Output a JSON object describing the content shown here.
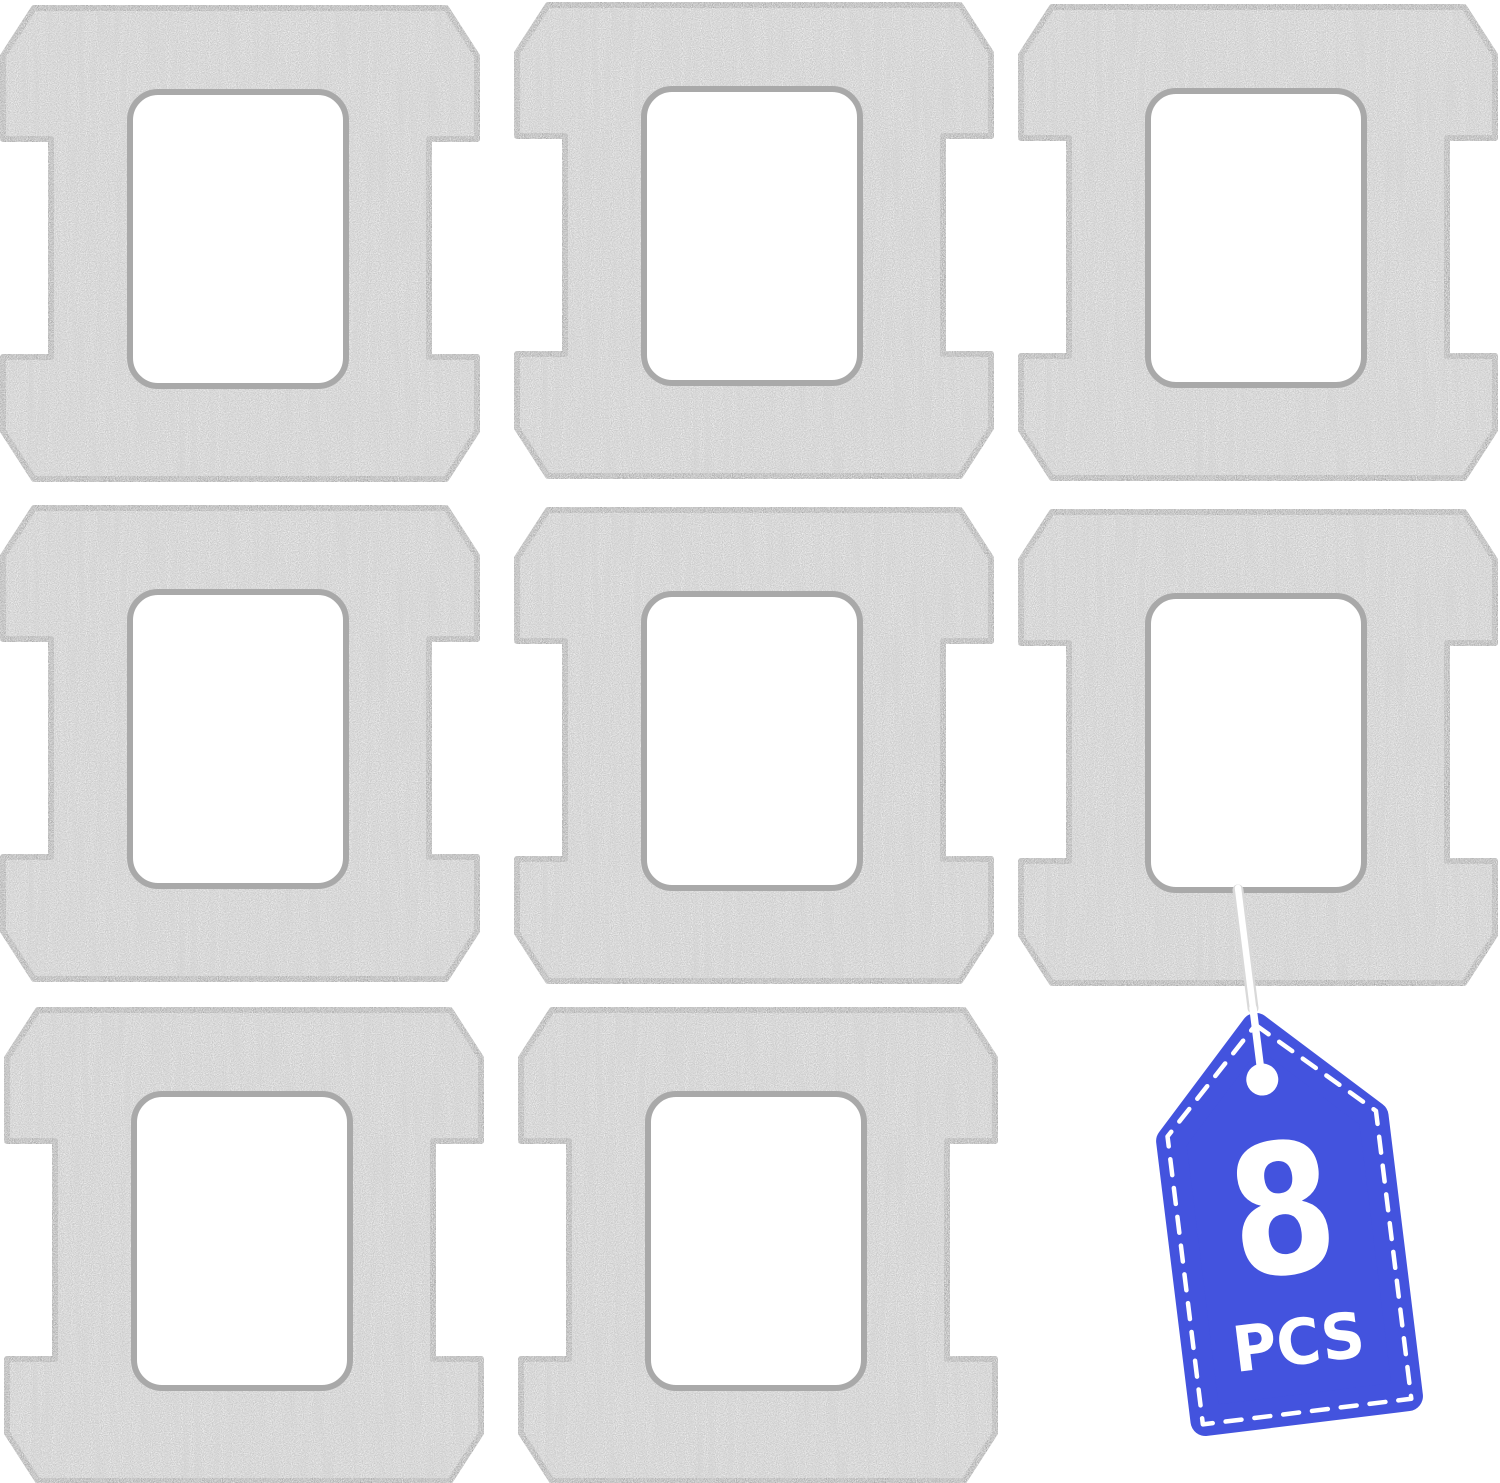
{
  "badge": {
    "count": "8",
    "unit": "PCS"
  },
  "colors": {
    "background": "#ffffff",
    "pad_fill": "#c9c9c9",
    "pad_edge": "#a8a8a8",
    "hole_fill": "#ffffff",
    "hole_edge": "#a9a9a9",
    "tag_blue": "#4353de",
    "tag_text": "#ffffff",
    "string_core": "#ffffff",
    "string_shadow": "#d9d9d9"
  },
  "pads": {
    "count": 8,
    "rows": 3,
    "cols": 3,
    "items": [
      {
        "id": "mop-pad-1",
        "row": 1,
        "col": 1,
        "x": 3,
        "y": 8
      },
      {
        "id": "mop-pad-2",
        "row": 1,
        "col": 2,
        "x": 517,
        "y": 5
      },
      {
        "id": "mop-pad-3",
        "row": 1,
        "col": 3,
        "x": 1021,
        "y": 7
      },
      {
        "id": "mop-pad-4",
        "row": 2,
        "col": 1,
        "x": 3,
        "y": 508
      },
      {
        "id": "mop-pad-5",
        "row": 2,
        "col": 2,
        "x": 517,
        "y": 510
      },
      {
        "id": "mop-pad-6",
        "row": 2,
        "col": 3,
        "x": 1021,
        "y": 512
      },
      {
        "id": "mop-pad-7",
        "row": 3,
        "col": 1,
        "x": 7,
        "y": 1010
      },
      {
        "id": "mop-pad-8",
        "row": 3,
        "col": 2,
        "x": 521,
        "y": 1010
      }
    ]
  },
  "tag": {
    "x": 1155,
    "y": 1133,
    "rotation": -7
  }
}
